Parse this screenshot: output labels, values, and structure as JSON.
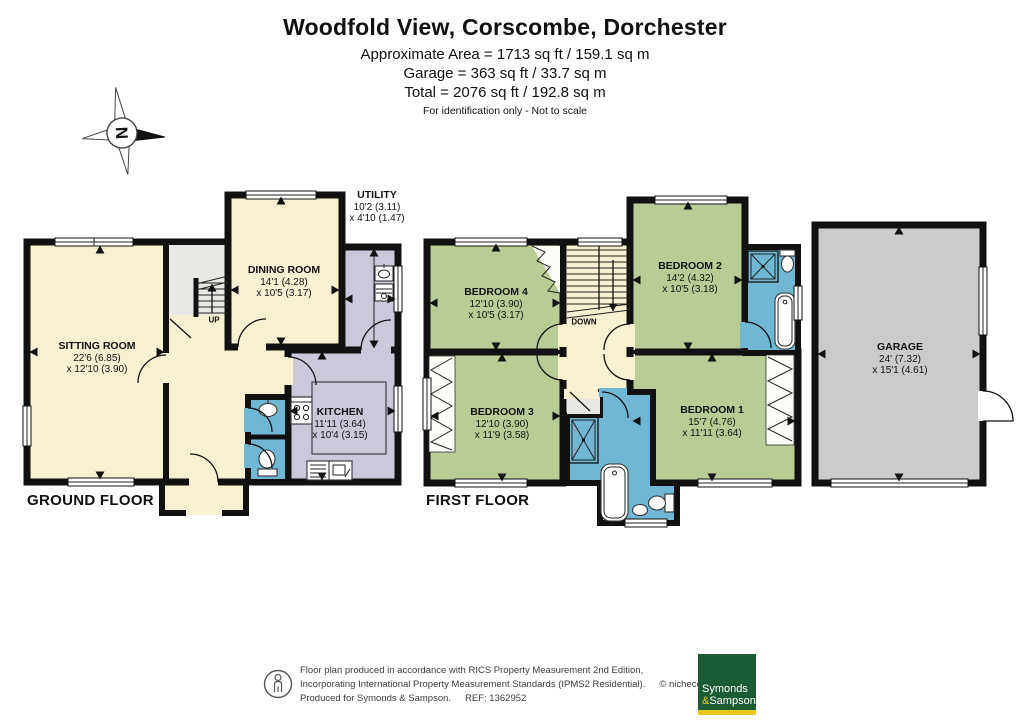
{
  "header": {
    "title": "Woodfold View, Corscombe, Dorchester",
    "area_line1": "Approximate Area = 1713 sq ft / 159.1 sq m",
    "area_line2": "Garage = 363 sq ft / 33.7 sq m",
    "area_line3": "Total = 2076 sq ft / 192.8 sq m",
    "disclaimer": "For identification only - Not to scale"
  },
  "compass": {
    "north_label": "N"
  },
  "floors": {
    "ground_label": "GROUND FLOOR",
    "first_label": "FIRST FLOOR"
  },
  "stairs": {
    "up_label": "UP",
    "down_label": "DOWN"
  },
  "rooms": {
    "sitting": {
      "name": "SITTING ROOM",
      "dim1": "22'6 (6.85)",
      "dim2": "x 12'10 (3.90)"
    },
    "dining": {
      "name": "DINING ROOM",
      "dim1": "14'1 (4.28)",
      "dim2": "x 10'5 (3.17)"
    },
    "utility": {
      "name": "UTILITY",
      "dim1": "10'2 (3.11)",
      "dim2": "x 4'10 (1.47)"
    },
    "kitchen": {
      "name": "KITCHEN",
      "dim1": "11'11 (3.64)",
      "dim2": "x 10'4 (3.15)"
    },
    "bedroom1": {
      "name": "BEDROOM 1",
      "dim1": "15'7 (4.76)",
      "dim2": "x 11'11 (3.64)"
    },
    "bedroom2": {
      "name": "BEDROOM 2",
      "dim1": "14'2 (4.32)",
      "dim2": "x 10'5 (3.18)"
    },
    "bedroom3": {
      "name": "BEDROOM 3",
      "dim1": "12'10 (3.90)",
      "dim2": "x 11'9 (3.58)"
    },
    "bedroom4": {
      "name": "BEDROOM 4",
      "dim1": "12'10 (3.90)",
      "dim2": "x 10'5 (3.17)"
    },
    "garage": {
      "name": "GARAGE",
      "dim1": "24' (7.32)",
      "dim2": "x 15'1 (4.61)"
    }
  },
  "footer": {
    "line1": "Floor plan produced in accordance with RICS Property Measurement 2nd Edition,",
    "line2": "Incorporating International Property Measurement Standards (IPMS2 Residential).",
    "copyright": "© nichecom 2025.",
    "line3": "Produced for Symonds & Sampson.",
    "ref": "REF:  1362952",
    "logo_line1": "Symonds",
    "logo_amp": "&",
    "logo_line2": "Sampson"
  },
  "palette": {
    "wall": "#111111",
    "room_cream": "#f8f1d1",
    "room_green": "#b9cc95",
    "room_lavender": "#c9c9da",
    "room_blue": "#6fb7d2",
    "garage_gray": "#cccbc9",
    "vestibule_gray": "#e9e8e4",
    "logo_green": "#1c5c34",
    "logo_gold": "#e8c71d"
  }
}
